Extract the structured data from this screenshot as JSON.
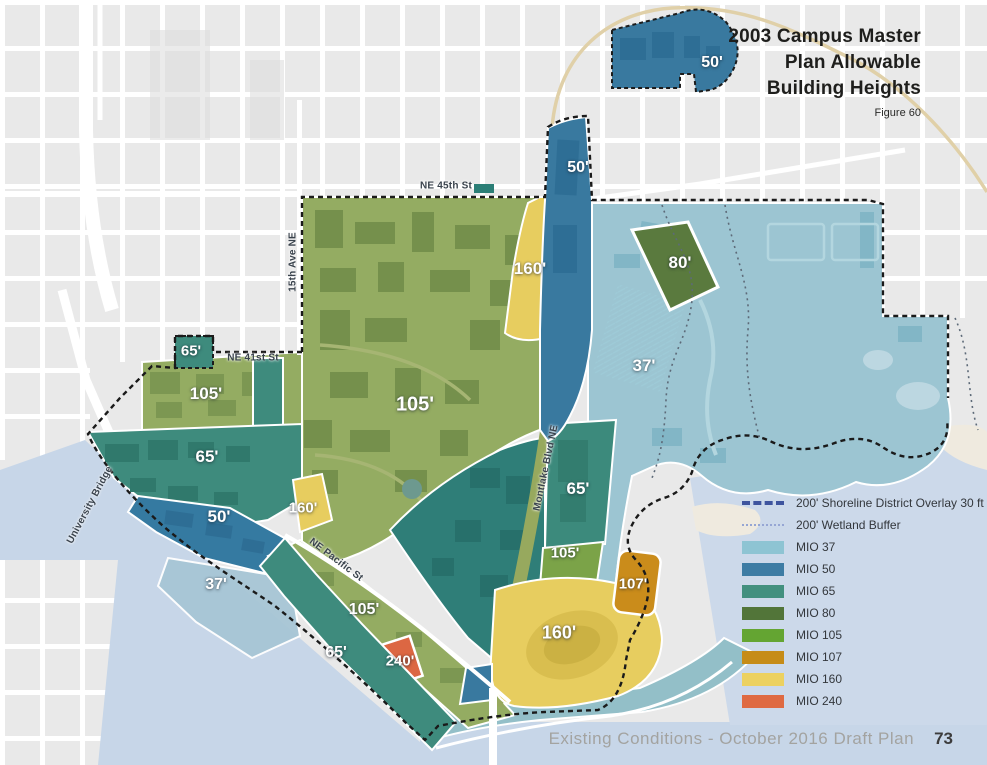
{
  "figure": {
    "title_lines": [
      "2003 Campus Master",
      "Plan Allowable",
      "Building Heights"
    ],
    "caption": "Figure 60"
  },
  "footer": {
    "text": "Existing Conditions - October 2016 Draft Plan",
    "page": "73"
  },
  "legend": {
    "line_items": [
      {
        "label": "200' Shoreline District Overlay 30 ft",
        "style": "shoreline"
      },
      {
        "label": "200' Wetland Buffer",
        "style": "wetland"
      }
    ],
    "mio_items": [
      {
        "label": "MIO 37",
        "color": "#8ec4d3"
      },
      {
        "label": "MIO 50",
        "color": "#3d7ca4"
      },
      {
        "label": "MIO 65",
        "color": "#42907f"
      },
      {
        "label": "MIO 80",
        "color": "#527539"
      },
      {
        "label": "MIO 105",
        "color": "#64a532"
      },
      {
        "label": "MIO 107",
        "color": "#c68c18"
      },
      {
        "label": "MIO 160",
        "color": "#ecd160"
      },
      {
        "label": "MIO 240",
        "color": "#df6a42"
      }
    ]
  },
  "map": {
    "height_labels": [
      {
        "text": "50'",
        "x": 712,
        "y": 63,
        "size": 16
      },
      {
        "text": "50'",
        "x": 578,
        "y": 168,
        "size": 16
      },
      {
        "text": "160'",
        "x": 530,
        "y": 269,
        "size": 17
      },
      {
        "text": "80'",
        "x": 680,
        "y": 263,
        "size": 17
      },
      {
        "text": "65'",
        "x": 191,
        "y": 351,
        "size": 15
      },
      {
        "text": "105'",
        "x": 206,
        "y": 394,
        "size": 17
      },
      {
        "text": "105'",
        "x": 415,
        "y": 405,
        "size": 20
      },
      {
        "text": "37'",
        "x": 644,
        "y": 366,
        "size": 17
      },
      {
        "text": "65'",
        "x": 207,
        "y": 457,
        "size": 17
      },
      {
        "text": "160'",
        "x": 303,
        "y": 508,
        "size": 15
      },
      {
        "text": "50'",
        "x": 219,
        "y": 517,
        "size": 17
      },
      {
        "text": "65'",
        "x": 578,
        "y": 489,
        "size": 17
      },
      {
        "text": "105'",
        "x": 565,
        "y": 553,
        "size": 15
      },
      {
        "text": "37'",
        "x": 216,
        "y": 585,
        "size": 16
      },
      {
        "text": "107'",
        "x": 633,
        "y": 584,
        "size": 15
      },
      {
        "text": "105'",
        "x": 364,
        "y": 610,
        "size": 16
      },
      {
        "text": "160'",
        "x": 559,
        "y": 633,
        "size": 18
      },
      {
        "text": "65'",
        "x": 336,
        "y": 653,
        "size": 16
      },
      {
        "text": "240'",
        "x": 400,
        "y": 661,
        "size": 15
      }
    ],
    "street_labels": [
      {
        "text": "NE 45th St",
        "x": 446,
        "y": 186,
        "rot": 0
      },
      {
        "text": "15th Ave NE",
        "x": 293,
        "y": 262,
        "rot": -90
      },
      {
        "text": "NE 41st St",
        "x": 253,
        "y": 358,
        "rot": 0
      },
      {
        "text": "University Bridge",
        "x": 90,
        "y": 505,
        "rot": -62
      },
      {
        "text": "NE Pacific St",
        "x": 336,
        "y": 560,
        "rot": 37
      },
      {
        "text": "Montlake Blvd NE",
        "x": 546,
        "y": 468,
        "rot": -78
      }
    ]
  },
  "colors": {
    "land": "#e9e9e9",
    "water": "#c7d6e8",
    "shoreline_dash": "#3e549e",
    "wetland_dash": "#96a6d4"
  }
}
